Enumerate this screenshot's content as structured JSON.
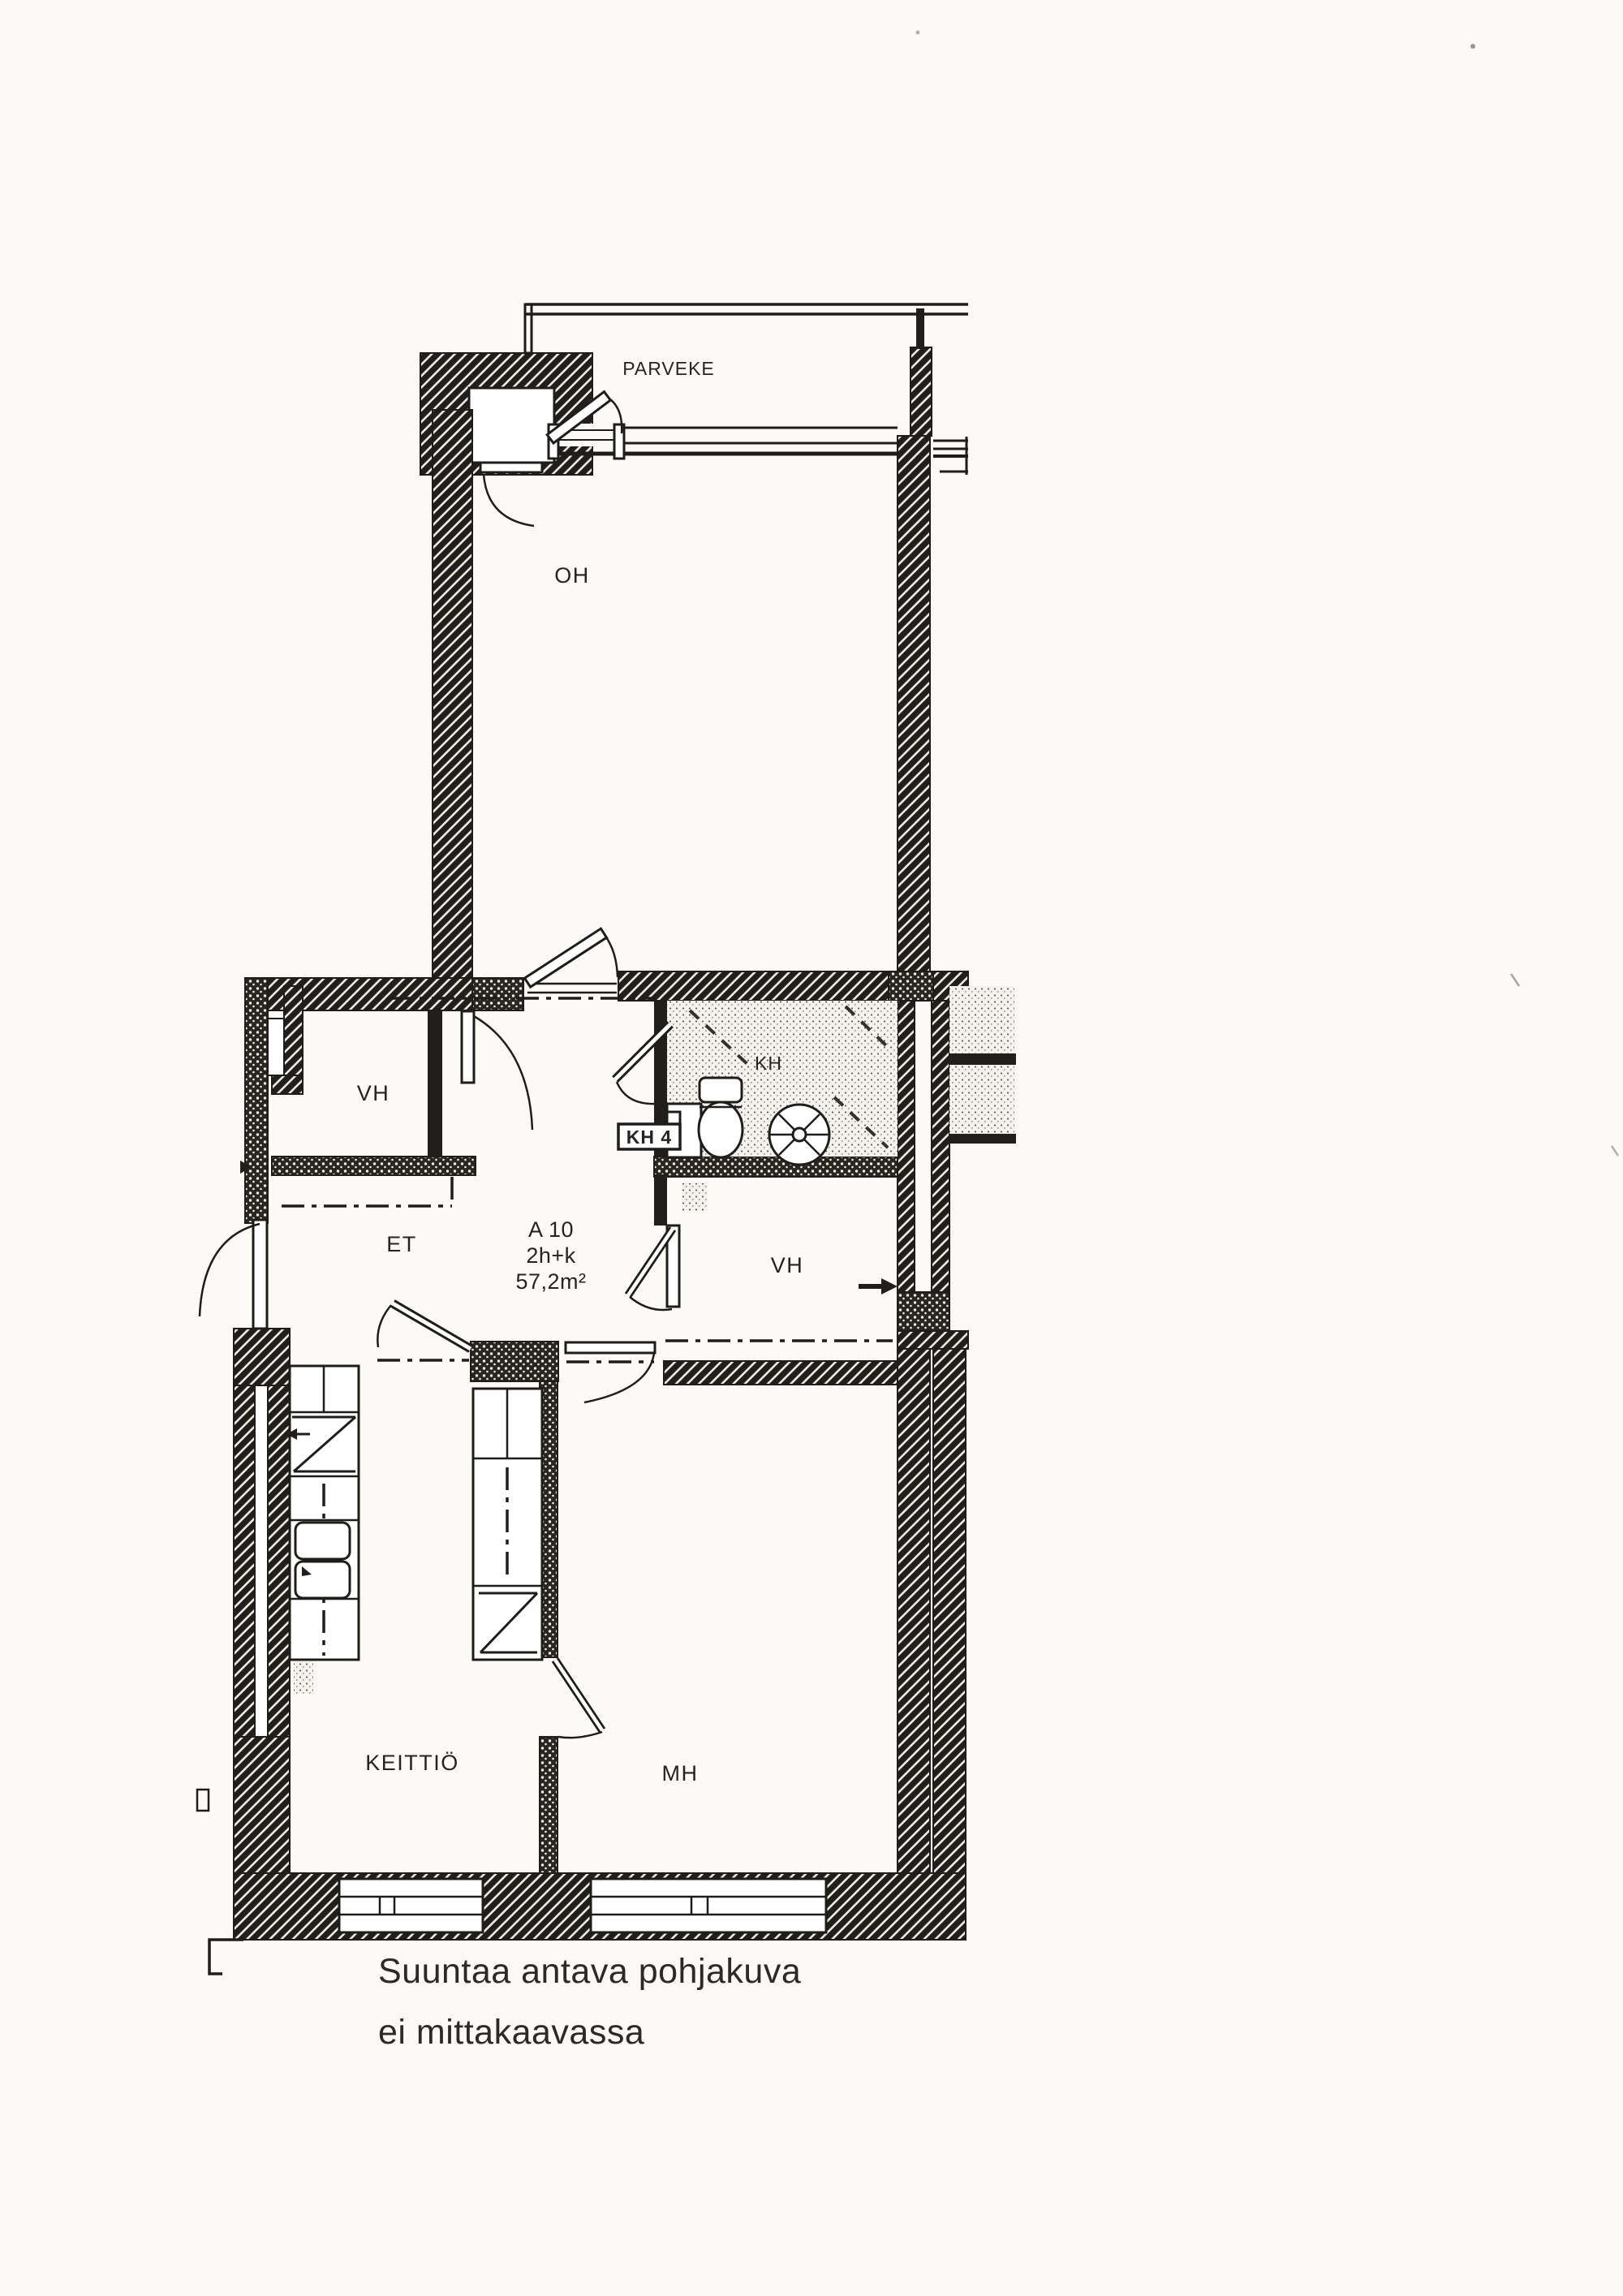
{
  "floor_plan": {
    "rooms": {
      "balcony": "PARVEKE",
      "living_room": "OH",
      "closet_left": "VH",
      "hallway": "ET",
      "bathroom": "KH",
      "closet_right": "VH",
      "kitchen": "KEITTIÖ",
      "bedroom": "MH"
    },
    "apartment": {
      "id": "A 10",
      "layout": "2h+k",
      "area": "57,2m²"
    },
    "bathroom_tag": "KH 4",
    "colors": {
      "ink": "#1f1d1a",
      "paper": "#fbfaf7"
    }
  },
  "caption": {
    "line1": "Suuntaa antava pohjakuva",
    "line2": "ei mittakaavassa"
  }
}
